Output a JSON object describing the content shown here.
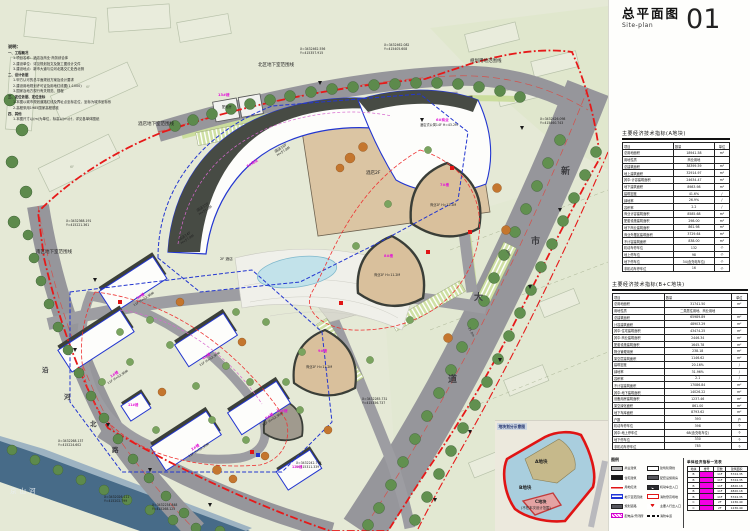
{
  "title": {
    "cn": "总平面图",
    "en": "Site-plan",
    "sheet_no": "01"
  },
  "notes": {
    "heading": "说明：",
    "lines": [
      {
        "t": "一、工程概况",
        "i": 0
      },
      {
        "t": "1.项目名称：酒店及商业·商务综合体",
        "i": 1
      },
      {
        "t": "2.建设单位：详见规划批文及施工图设计文件",
        "i": 1
      },
      {
        "t": "3.建设地点：新市大道与沿河北路交汇处西北侧",
        "i": 1
      },
      {
        "t": "二、设计依据",
        "i": 0
      },
      {
        "t": "1.甲方认可的总平面规划方案及设计要求",
        "i": 1
      },
      {
        "t": "2.建设用地规划许可证及用地红线图(1:1000)",
        "i": 1
      },
      {
        "t": "3.国家及地方现行有关规范、规程",
        "i": 1
      },
      {
        "t": "三、定位依据、定位坐标",
        "i": 0
      },
      {
        "t": "1.本图以城市规划道路红线及界址点坐标定位，坐标为城市坐标系",
        "i": 1
      },
      {
        "t": "2.高程采用1985国家高程基准",
        "i": 1
      },
      {
        "t": "四、其他",
        "i": 0
      },
      {
        "t": "1.本图尺寸以(m)为单位，标高以(m)计，详见各单体图纸",
        "i": 1
      }
    ]
  },
  "tables": [
    {
      "heading": "主要经济技术指标(A地块)",
      "columns": [
        "项目",
        "数量",
        "单位"
      ],
      "rows": [
        [
          "总用地面积",
          "18941.58",
          "m²"
        ],
        [
          "用地性质",
          "商业用地",
          ""
        ],
        [
          "总建筑面积",
          "38399.59",
          "m²"
        ],
        [
          "地上建筑面积",
          "32914.97",
          "m²"
        ],
        [
          "其中:计容建筑面积",
          "24634.47",
          "m²"
        ],
        [
          "地下建筑面积",
          "8983.98",
          "m²"
        ],
        [
          "建筑密度",
          "41.6%",
          "/"
        ],
        [
          "绿地率",
          "26.9%",
          "/"
        ],
        [
          "容积率",
          "2.2",
          "/"
        ],
        [
          "商业计容建筑面积",
          "8585.68",
          "m²"
        ],
        [
          "配套设施建筑面积",
          "298.00",
          "m²"
        ],
        [
          "地下商业建筑面积",
          "861.98",
          "m²"
        ],
        [
          "商业外摆区建筑面积",
          "3729.64",
          "m²"
        ],
        [
          "不计容建筑面积",
          "838.00",
          "m²"
        ],
        [
          "机动车停车位",
          "132",
          "个"
        ],
        [
          "地上停车位",
          "98",
          "个"
        ],
        [
          "地下停车位",
          "34(含充电车位)",
          "个"
        ],
        [
          "非机动车停车位",
          "16",
          "个"
        ]
      ]
    },
    {
      "heading": "主要经济技术指标(B+C地块)",
      "columns": [
        "项目",
        "数量",
        "单位"
      ],
      "rows": [
        [
          "总用地面积",
          "31741.50",
          "m²"
        ],
        [
          "用地性质",
          "二类居住用地、商业用地",
          ""
        ],
        [
          "总建筑面积",
          "65989.89",
          "m²"
        ],
        [
          "计容建筑面积",
          "48903.29",
          "m²"
        ],
        [
          "其中:住宅建筑面积",
          "43474.25",
          "m²"
        ],
        [
          "其中:商业建筑面积",
          "2446.34",
          "m²"
        ],
        [
          "配套设施建筑面积",
          "1645.78",
          "m²"
        ],
        [
          "物业管理用房",
          "238.18",
          "m²"
        ],
        [
          "架空层建筑面积",
          "1146.62",
          "m²"
        ],
        [
          "建筑密度",
          "20.16%",
          "/"
        ],
        [
          "绿地率",
          "31.96%",
          "/"
        ],
        [
          "容积率",
          "2.1",
          "/"
        ],
        [
          "不计容建筑面积",
          "17086.84",
          "m²"
        ],
        [
          "其中:地下建筑面积",
          "14026.22",
          "m²"
        ],
        [
          "设备用房建筑面积",
          "1237.46",
          "m²"
        ],
        [
          "架空绿化面积",
          "861.00",
          "m²"
        ],
        [
          "地下车库面积",
          "8793.62",
          "m²"
        ],
        [
          "户数",
          "393",
          "户"
        ],
        [
          "机动车停车位",
          "398",
          "个"
        ],
        [
          "其中:地上停车位",
          "68(含充电车位)",
          "个"
        ],
        [
          "地下停车位",
          "330",
          "个"
        ],
        [
          "非机动车停车位",
          "785",
          "个"
        ]
      ]
    }
  ],
  "legend": {
    "heading": "图例",
    "items": [
      {
        "type": "gray",
        "label": "商业建筑"
      },
      {
        "type": "white",
        "label": "建筑轮廓线"
      },
      {
        "type": "black",
        "label": "住宅建筑"
      },
      {
        "type": "dark",
        "label": "配套设施用房"
      },
      {
        "type": "redline",
        "label": "用地红线"
      },
      {
        "type": "arrow",
        "label": "机动车出入口",
        "glyph": "➤"
      },
      {
        "type": "blueline",
        "label": "地下室范围线"
      },
      {
        "type": "redbox",
        "label": "消防登高场地"
      },
      {
        "type": "dark",
        "label": "规划道路"
      },
      {
        "type": "redmark",
        "label": "主要人行出入口",
        "glyph": "♥"
      },
      {
        "type": "magenta",
        "label": "配电房/开闭所"
      },
      {
        "type": "dash",
        "label": "消防车道"
      }
    ]
  },
  "unit_table": {
    "heading": "单体经济指标一览表",
    "columns": [
      "地块",
      "楼号",
      "层数",
      "建筑面积"
    ],
    "rows": [
      [
        "B",
        "1#楼",
        "11F",
        "5724.35"
      ],
      [
        "B",
        "2#楼",
        "11F",
        "5724.35"
      ],
      [
        "B",
        "3#楼",
        "11F",
        "4820.18"
      ],
      [
        "B",
        "4#楼",
        "11F",
        "4820.18"
      ],
      [
        "B",
        "5#楼",
        "11F",
        "5724.35"
      ],
      [
        "C",
        "7#楼",
        "2F",
        "1236.40"
      ],
      [
        "C",
        "8#楼",
        "2F",
        "1236.40"
      ]
    ]
  },
  "inset": {
    "heading": "地块划分示意图",
    "a": "A地块",
    "b": "B地块",
    "c": "C地块",
    "c_note": "(不在本次设计范围)"
  },
  "plan": {
    "river_name": "京山河",
    "road_east_chars": [
      "新",
      "市",
      "大",
      "道"
    ],
    "road_west_chars": [
      "沿",
      "河",
      "北",
      "路"
    ],
    "dims": [
      "15.0m",
      "10m"
    ],
    "context_labels": [
      "6F",
      "6F"
    ],
    "boundary_labels": [
      "北区地下室范围线",
      "规划用地范围线",
      "酒店地下室范围线",
      "南区地下室范围线"
    ],
    "coords": [
      {
        "x": "X=3432462.556",
        "y": "Y=415357.915"
      },
      {
        "x": "X=3432462.082",
        "y": "Y=415405.608"
      },
      {
        "x": "X=3432426.098",
        "y": "Y=415460.743"
      },
      {
        "x": "X=3432368.191",
        "y": "Y=415221.361"
      },
      {
        "x": "X=3432268.137",
        "y": "Y=415224.602"
      },
      {
        "x": "X=3432026.111",
        "y": "Y=415202.799"
      },
      {
        "x": "X=3432234.848",
        "y": "Y=415268.125"
      },
      {
        "x": "X=3432242.799",
        "y": "Y=415311.339"
      },
      {
        "x": "X=3432285.731",
        "y": "Y=415356.737"
      }
    ],
    "buildings": [
      {
        "label": "酒店16F",
        "sub": "H=57.8M"
      },
      {
        "label": "酒店15F",
        "sub": "H=51.3M"
      },
      {
        "label": "酒店14F",
        "sub": "H=57.9M"
      },
      {
        "label": "2F 酒店",
        "sub": ""
      },
      {
        "label": "酒店2F",
        "sub": ""
      },
      {
        "label": "5#商业",
        "sub": ""
      },
      {
        "label": "6#商业",
        "sub": "酒店式公寓14F H=43.2M"
      },
      {
        "label": "7#楼",
        "sub": "商业2F H=11.2M"
      },
      {
        "label": "8#楼",
        "sub": "商业2F H=11.2M"
      },
      {
        "label": "9#楼",
        "sub": "商业2F H=11.2M"
      },
      {
        "label": "10#楼",
        "sub": ""
      },
      {
        "label": "13#楼",
        "sub": "配电房"
      },
      {
        "label": "1#楼",
        "sub": "11F H=53.95M"
      },
      {
        "label": "2#楼",
        "sub": "11F H=53.95M"
      },
      {
        "label": "3#楼",
        "sub": "11F H=53.95M"
      },
      {
        "label": "4#楼",
        "sub": "11F H=53.95M"
      },
      {
        "label": "5#楼",
        "sub": "11F H=53.95M"
      },
      {
        "label": "11#楼",
        "sub": ""
      },
      {
        "label": "12#楼",
        "sub": ""
      }
    ],
    "colors": {
      "boundary_red": "#e61919",
      "basement_blue": "#2336d0",
      "label_magenta": "#e313d6",
      "road_gray": "#96969b",
      "river_blue": "#476b88",
      "building_tan": "#dbc5a3"
    }
  }
}
